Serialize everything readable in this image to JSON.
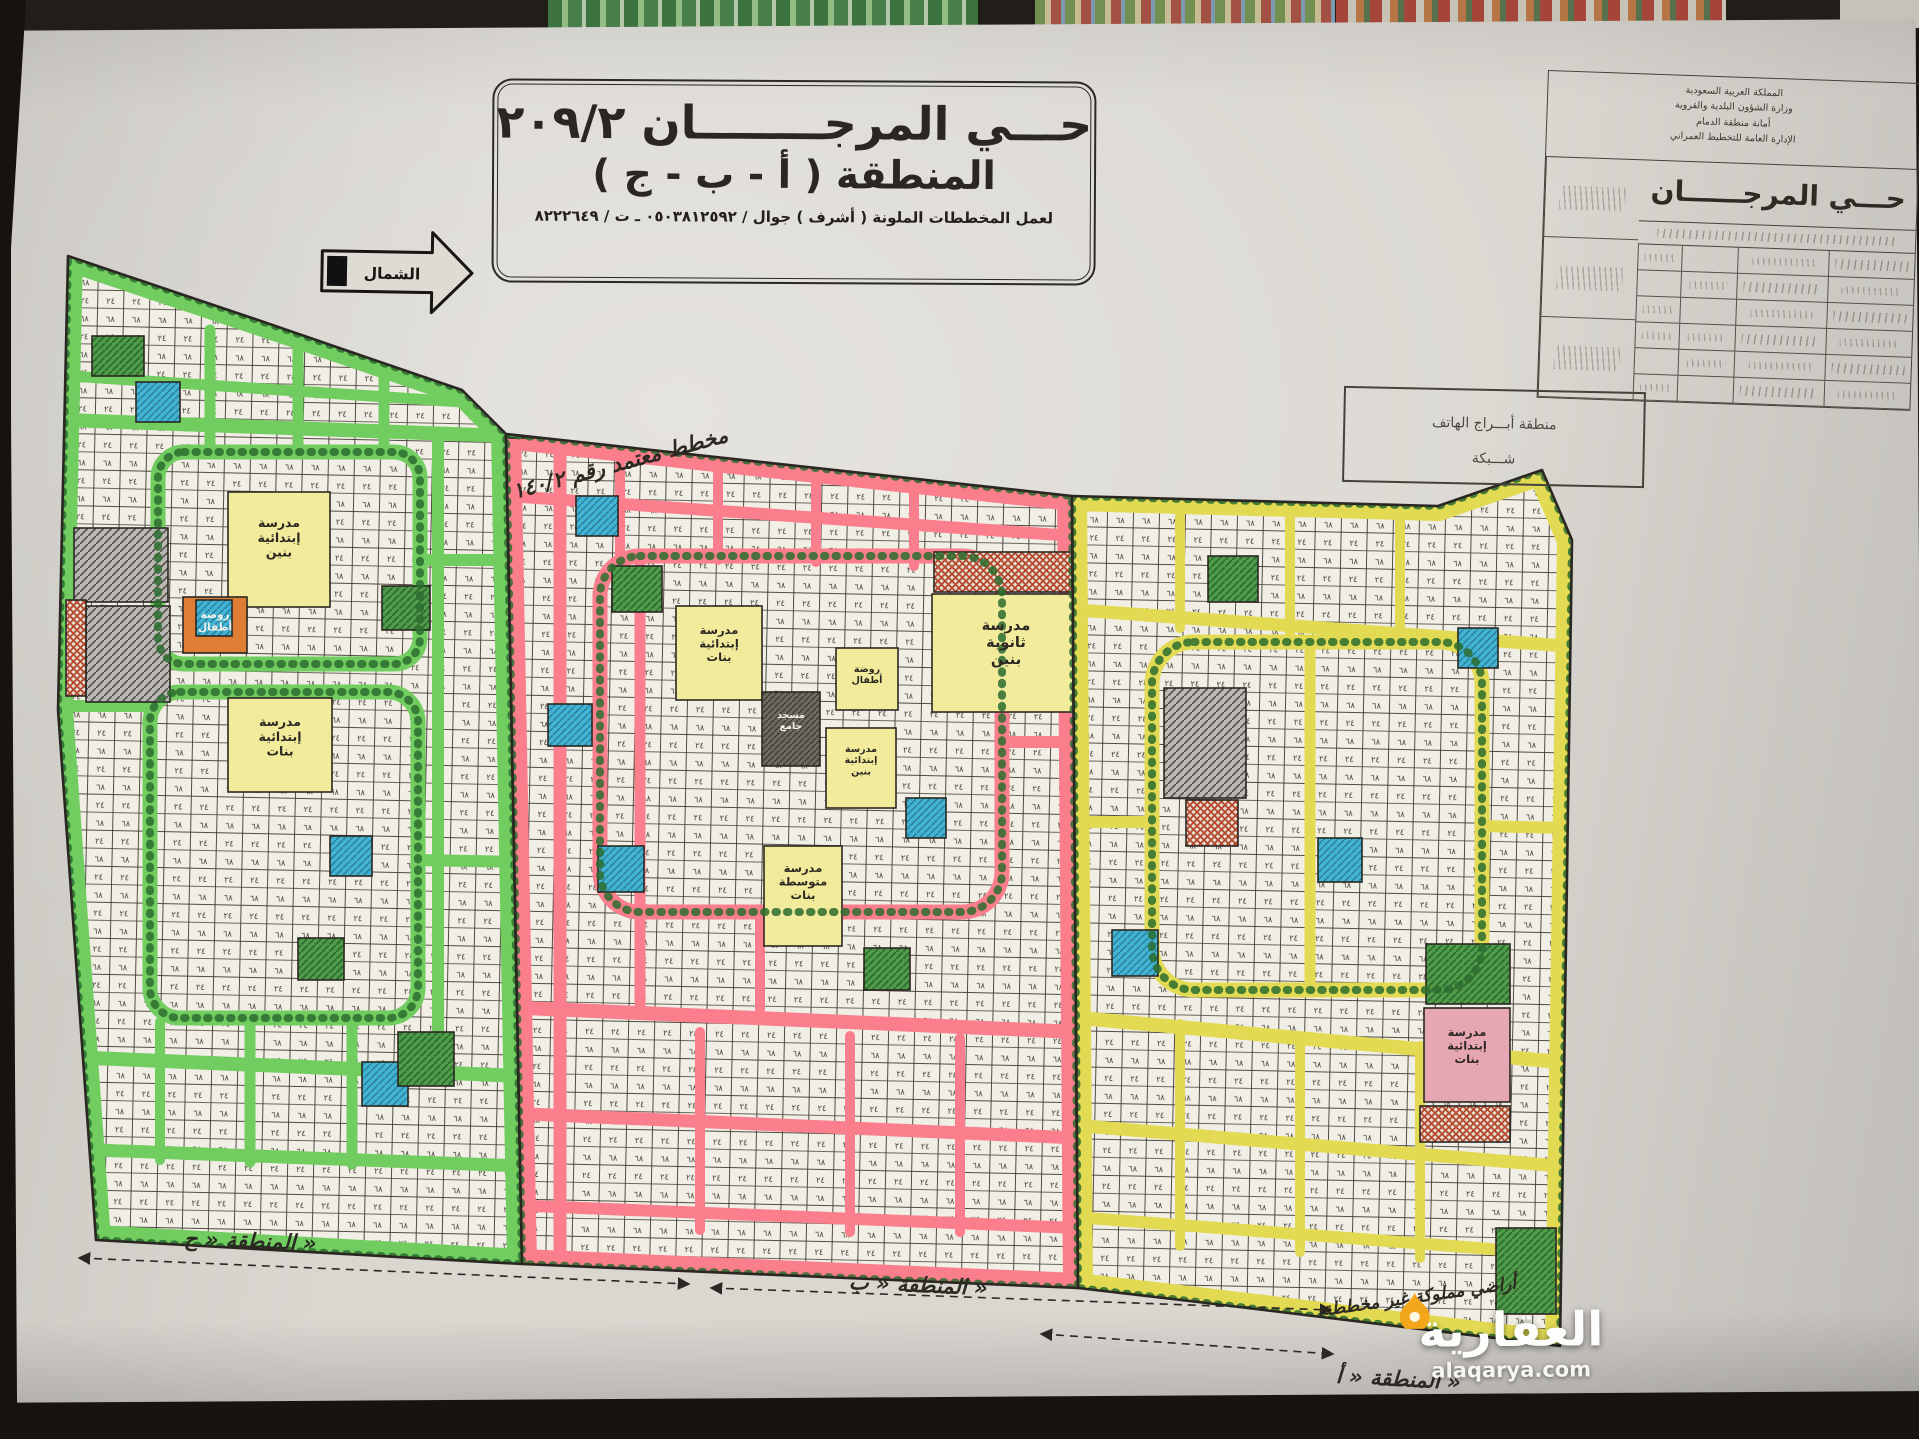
{
  "title_box": {
    "line1": "حـــي المرجــــــــان ٢٠٩/٢",
    "line2": "المنطقة ( أ - ب - ج )",
    "line3": "لعمل المخططات الملونة ( أشرف ) جوال / ٠٥٠٣٨١٢٥٩٢ ـ ت / ٨٢٢٢٦٤٩"
  },
  "north_arrow": {
    "label": "الشمال"
  },
  "approval_note": {
    "text": "مخطط معتمد رقم ١٤٠/٢"
  },
  "info_block": {
    "header_lines": [
      "المملكة العربية السعودية",
      "وزارة الشؤون البلدية والقروية",
      "أمانة منطقة الدمام",
      "الإدارة العامة للتخطيط العمراني"
    ],
    "district_name": "حـــي المرجــــــان"
  },
  "phone_box": {
    "line1": "منطقة أبـــراج الهاتف",
    "line2": "شـــبكة"
  },
  "map": {
    "plot_numeral_top": "٢٤",
    "plot_numeral_bottom": "٦٨",
    "zones": {
      "c": {
        "name": "المنطقة « ج »"
      },
      "b": {
        "name": "المنطقة « ب »"
      },
      "a": {
        "name": "المنطقة « أ »"
      }
    },
    "ownership_note": "أراضي مملوكة غير مخططة",
    "landmarks": {
      "green_school_boys": "مدرسة|إبتدائية|بنين",
      "green_kindergarten": "روضة|أطفال",
      "green_school_girls": "مدرسة|إبتدائية|بنات",
      "pink_school_secondary_boys": "مدرسة|ثانوية|بنين",
      "pink_school_girls": "مدرسة|إبتدائية|بنات",
      "pink_kindergarten": "روضة|أطفال",
      "pink_mosque": "مسجد|جامع",
      "pink_school_boys": "مدرسة|إبتدائية|بنين",
      "pink_school_middle_girls": "مدرسة|متوسطة|بنات",
      "yellow_school_girls": "مدرسة|إبتدائية|بنات"
    }
  },
  "watermark": {
    "brand": "العقارية",
    "url": "alaqarya.com"
  },
  "colors": {
    "zone_green": "#72cd60",
    "zone_pink": "#fa7e8c",
    "zone_yellow": "#e2da52",
    "plot_fill": "#f1eee6",
    "mosque_blue": "#41b4d5",
    "school_yellow": "#f3eb9c",
    "school_pink": "#e7a6b3",
    "kindergarten_orange": "#df7f36",
    "park_green": "#4f9c49",
    "tree_green": "#2c6d2f",
    "ink": "#2a2722",
    "paper": "#dad7d1",
    "photo_black": "#17140f",
    "watermark_yellow": "#f2a71b"
  }
}
